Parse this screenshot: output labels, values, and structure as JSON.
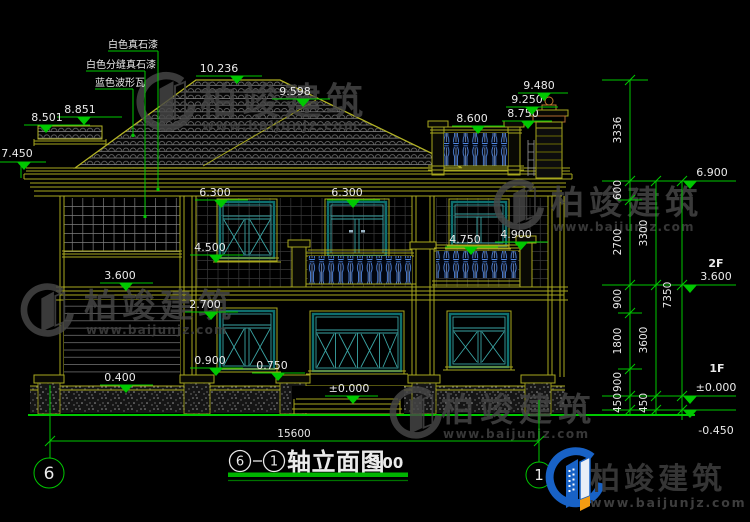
{
  "materials": [
    "白色真石漆",
    "白色分缝真石漆",
    "蓝色波形瓦"
  ],
  "ann": {
    "ridge": "10.236",
    "hip": "9.598",
    "canopy_top": "8.851",
    "canopy_eave": "8.501",
    "eave_far_left": "7.450",
    "eave_l": "6.300",
    "eave_r": "6.300",
    "sill_2f": "4.500",
    "terrace_rail": "8.600",
    "parapet": "8.750",
    "chimney_shoulder": "9.250",
    "chimney_top": "9.480",
    "rail_center": "4.750",
    "rail_right": "4.900",
    "floor_2f": "3.600",
    "lintel_1f": "2.700",
    "sill_1f_a": "0.900",
    "sill_1f_b": "0.750",
    "plinth": "0.400",
    "zero": "±0.000"
  },
  "right": {
    "top": "6.900",
    "f2_label": "2F",
    "f2": "3.600",
    "f1_label": "1F",
    "f1": "±0.000",
    "below": "-0.450"
  },
  "dims": {
    "col1": [
      "3336",
      "600",
      "2700",
      "900",
      "1800",
      "900",
      "450"
    ],
    "col2": [
      "3300",
      "3600",
      "450"
    ],
    "col3": [
      "7350"
    ],
    "width": "15600"
  },
  "axes": {
    "left": "6",
    "right": "1"
  },
  "title": {
    "bubble_a": "6",
    "bubble_b": "1",
    "name": "轴立面图",
    "scale": ":100"
  },
  "watermark": {
    "brand": "柏竣建筑",
    "url": "www.baijunjz.com"
  },
  "logo": {
    "brand": "柏竣建筑",
    "url": "www.baijunjz.com"
  },
  "colors": {
    "line_yellow": "#a8a81e",
    "annotation_green": "#00c800",
    "window_teal": "#0e6f6f",
    "baluster_blue": "#4f86e0",
    "text_white": "#eaeaea",
    "watermark_gray": "#474747",
    "logo_blue": "#1862c6",
    "logo_orange": "#f39c12",
    "background": "#000000"
  }
}
